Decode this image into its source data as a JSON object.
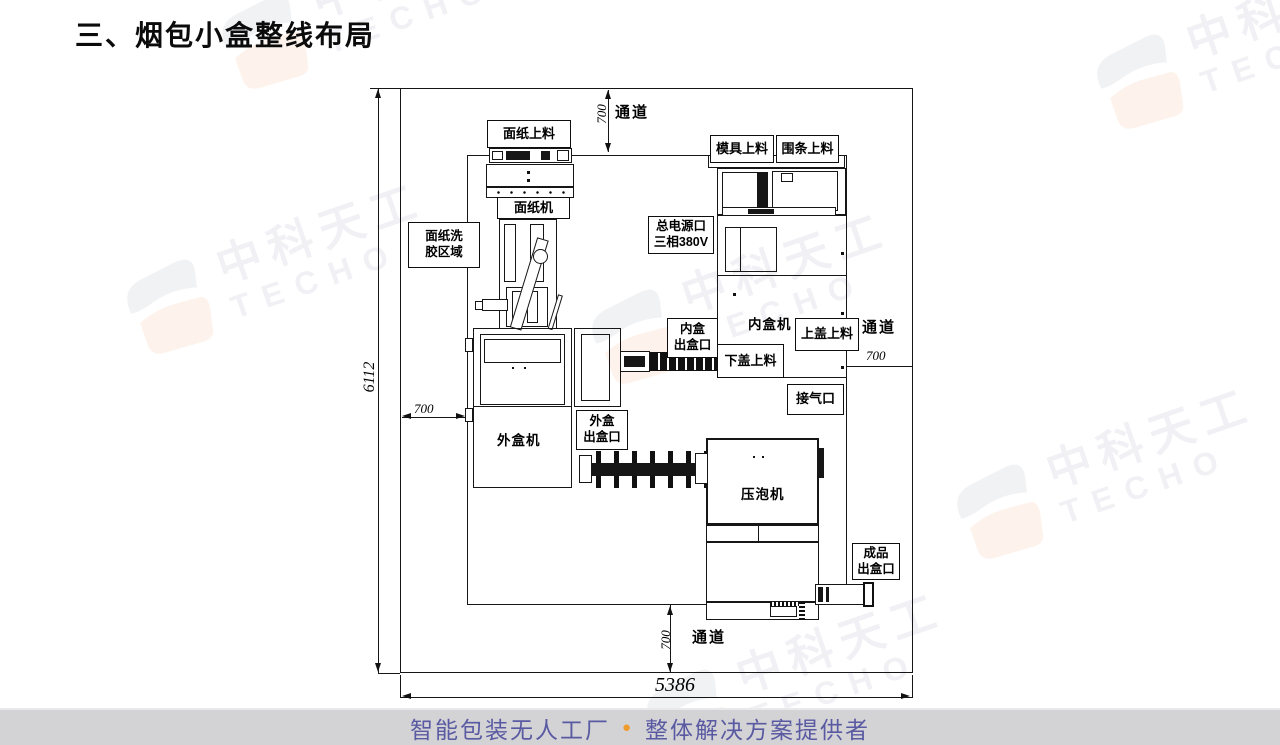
{
  "title": "三、烟包小盒整线布局",
  "footer": {
    "part1": "智能包装无人工厂",
    "bullet": "●",
    "part2": "整体解决方案提供者",
    "accent_color": "#f09b2d",
    "text_color": "#5a5aa2"
  },
  "watermark": {
    "cn": "中科天工",
    "en": "TECHO"
  },
  "diagram": {
    "corridor": "通道",
    "dims": {
      "height": "6112",
      "width": "5386",
      "corridor": "700"
    },
    "labels": {
      "paper_feed": "面纸上料",
      "paper_machine": "面纸机",
      "glue_wash": [
        "面纸洗",
        "胶区域"
      ],
      "mold_feed": "模具上料",
      "ring_feed": "围条上料",
      "main_power": [
        "总电源口",
        "三相380V"
      ],
      "inner_box_machine": "内盒机",
      "top_lid_feed": "上盖上料",
      "inner_box_outlet": [
        "内盒",
        "出盒口"
      ],
      "bottom_lid_feed": "下盖上料",
      "air_port": "接气口",
      "outer_box_machine": "外盒机",
      "outer_box_outlet": [
        "外盒",
        "出盒口"
      ],
      "press_machine": "压泡机",
      "product_outlet": [
        "成品",
        "出盒口"
      ]
    }
  }
}
